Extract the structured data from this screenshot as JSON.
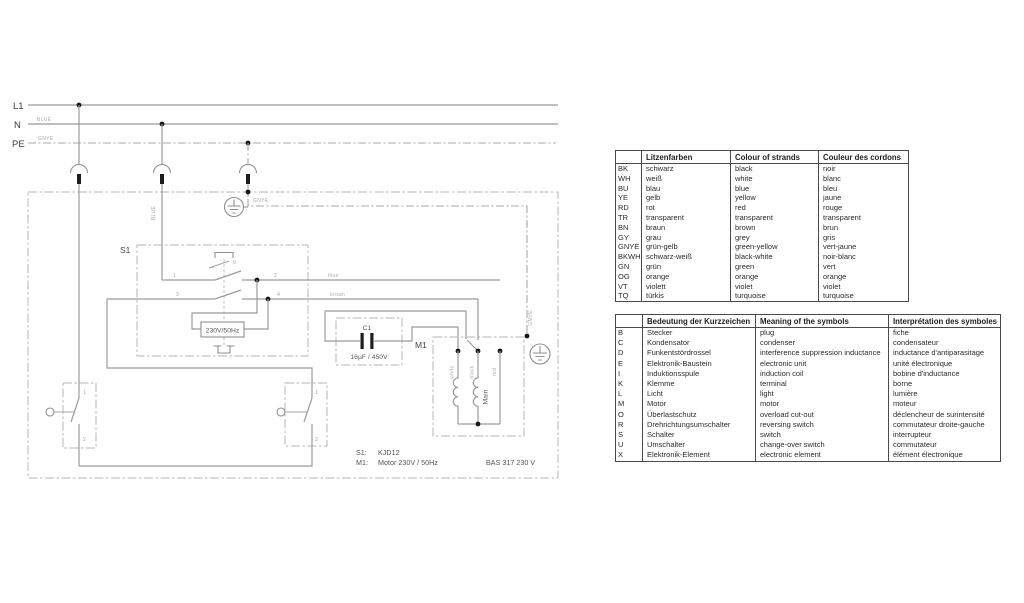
{
  "diagram": {
    "rails": {
      "l1": "L1",
      "n": "N",
      "pe": "PE",
      "n_tag": "BLUE",
      "pe_tag": "GNYE"
    },
    "tags": {
      "blue_drop": "BLUE",
      "gnye_top": "GNYE",
      "gnye_right": "GNYE",
      "wire_blue": "blue",
      "wire_brown": "brown"
    },
    "s1": {
      "label": "S1",
      "coil": "230V/50Hz",
      "t0": "0",
      "t1": "1",
      "t2": "2",
      "t3": "3",
      "t4": "4"
    },
    "c1": {
      "label": "C1",
      "value": "16µF / 450V"
    },
    "m1": {
      "label": "M1",
      "white": "white",
      "black": "black",
      "red": "red",
      "main": "Main"
    },
    "sw1": {
      "t1": "1",
      "t2": "2"
    },
    "sw2": {
      "t1": "1",
      "t2": "2"
    },
    "footer": {
      "s1_key": "S1:",
      "s1_val": "KJD12",
      "m1_key": "M1:",
      "m1_val": "Motor 230V / 50Hz",
      "model": "BAS 317  230 V"
    }
  },
  "color_table": {
    "headers": [
      "",
      "Litzenfarben",
      "Colour of strands",
      "Couleur des cordons"
    ],
    "rows": [
      [
        "BK",
        "schwarz",
        "black",
        "noir"
      ],
      [
        "WH",
        "weiß",
        "white",
        "blanc"
      ],
      [
        "BU",
        "blau",
        "blue",
        "bleu"
      ],
      [
        "YE",
        "gelb",
        "yellow",
        "jaune"
      ],
      [
        "RD",
        "rot",
        "red",
        "rouge"
      ],
      [
        "TR",
        "transparent",
        "transparent",
        "transparent"
      ],
      [
        "BN",
        "braun",
        "brown",
        "brun"
      ],
      [
        "GY",
        "grau",
        "grey",
        "gris"
      ],
      [
        "GNYE",
        "grün-gelb",
        "green-yellow",
        "vert-jaune"
      ],
      [
        "BKWH",
        "schwarz-weiß",
        "black-white",
        "noir-blanc"
      ],
      [
        "GN",
        "grün",
        "green",
        "vert"
      ],
      [
        "OG",
        "orange",
        "orange",
        "orange"
      ],
      [
        "VT",
        "violett",
        "violet",
        "violet"
      ],
      [
        "TQ",
        "türkis",
        "turquoise",
        "turquoise"
      ]
    ]
  },
  "symbol_table": {
    "headers": [
      "",
      "Bedeutung der Kurzzeichen",
      "Meaning of the symbols",
      "Interprétation des symboles"
    ],
    "rows": [
      [
        "B",
        "Stecker",
        "plug",
        "fiche"
      ],
      [
        "C",
        "Kondensator",
        "condenser",
        "condensateur"
      ],
      [
        "D",
        "Funkentstördrossel",
        "interference suppression inductance",
        "inductance d'antiparasitage"
      ],
      [
        "E",
        "Elektronik-Baustein",
        "electronic unit",
        "unité électronique"
      ],
      [
        "I",
        "Induktionsspule",
        "induction coil",
        "bobine d'inductance"
      ],
      [
        "K",
        "Klemme",
        "terminal",
        "borne"
      ],
      [
        "L",
        "Licht",
        "light",
        "lumière"
      ],
      [
        "M",
        "Motor",
        "motor",
        "moteur"
      ],
      [
        "O",
        "Überlastschutz",
        "overload cut-out",
        "déclencheur de surintensité"
      ],
      [
        "R",
        "Drehrichtungsumschalter",
        "reversing switch",
        "commutateur droite-gauche"
      ],
      [
        "S",
        "Schalter",
        "switch",
        "interrupteur"
      ],
      [
        "U",
        "Umschalter",
        "change-over switch",
        "commutateur"
      ],
      [
        "X",
        "Elektronik-Element",
        "electronic element",
        "élément électronique"
      ]
    ]
  }
}
